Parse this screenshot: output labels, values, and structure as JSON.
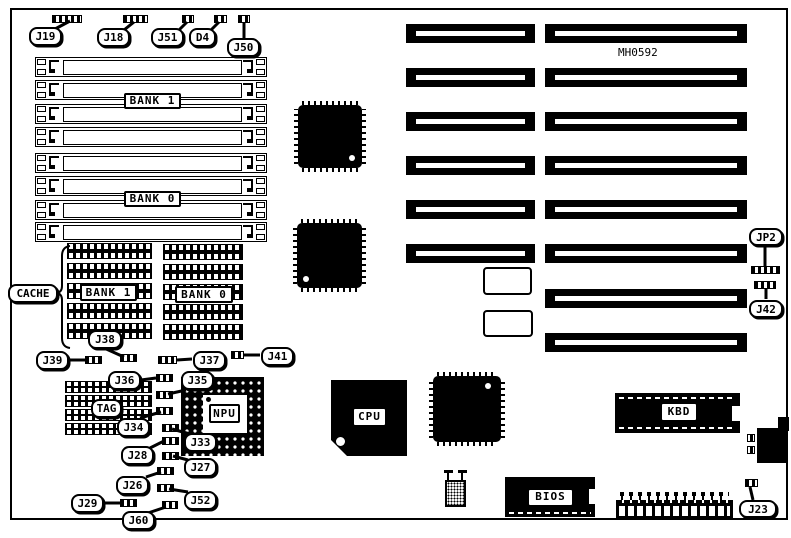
{
  "part_number": "MH0592",
  "memory": {
    "bank1": "BANK 1",
    "bank0": "BANK 0"
  },
  "cache": {
    "label": "CACHE",
    "bank1": "BANK 1",
    "bank0": "BANK 0"
  },
  "chips": {
    "cpu": "CPU",
    "npu": "NPU",
    "bios": "BIOS",
    "kbd": "KBD",
    "tag": "TAG"
  },
  "jumpers": {
    "j19": "J19",
    "j18": "J18",
    "j51": "J51",
    "d4": "D4",
    "j50": "J50",
    "j39": "J39",
    "j38": "J38",
    "j37": "J37",
    "j41": "J41",
    "j36": "J36",
    "j35": "J35",
    "j34": "J34",
    "j33": "J33",
    "j28": "J28",
    "j27": "J27",
    "j26": "J26",
    "j52": "J52",
    "j29": "J29",
    "j60": "J60",
    "jp2": "JP2",
    "j42": "J42",
    "j23": "J23"
  }
}
